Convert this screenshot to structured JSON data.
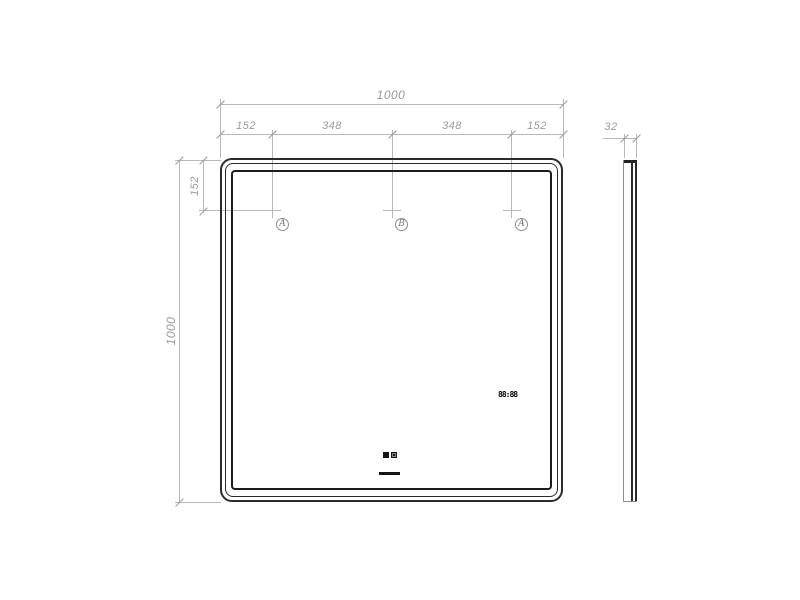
{
  "dimensions": {
    "overall_width": "1000",
    "top_segments": [
      "152",
      "348",
      "348",
      "152"
    ],
    "top_offset": "152",
    "overall_height": "1000",
    "depth": "32"
  },
  "markers": {
    "left": "A",
    "center": "B",
    "right": "A"
  },
  "display": {
    "clock": "88:88"
  },
  "colors": {
    "frame_line": "#2b2b2b",
    "dimension_line": "#b8b8b8",
    "dimension_text": "#9a9a9a",
    "display_black": "#141414"
  }
}
